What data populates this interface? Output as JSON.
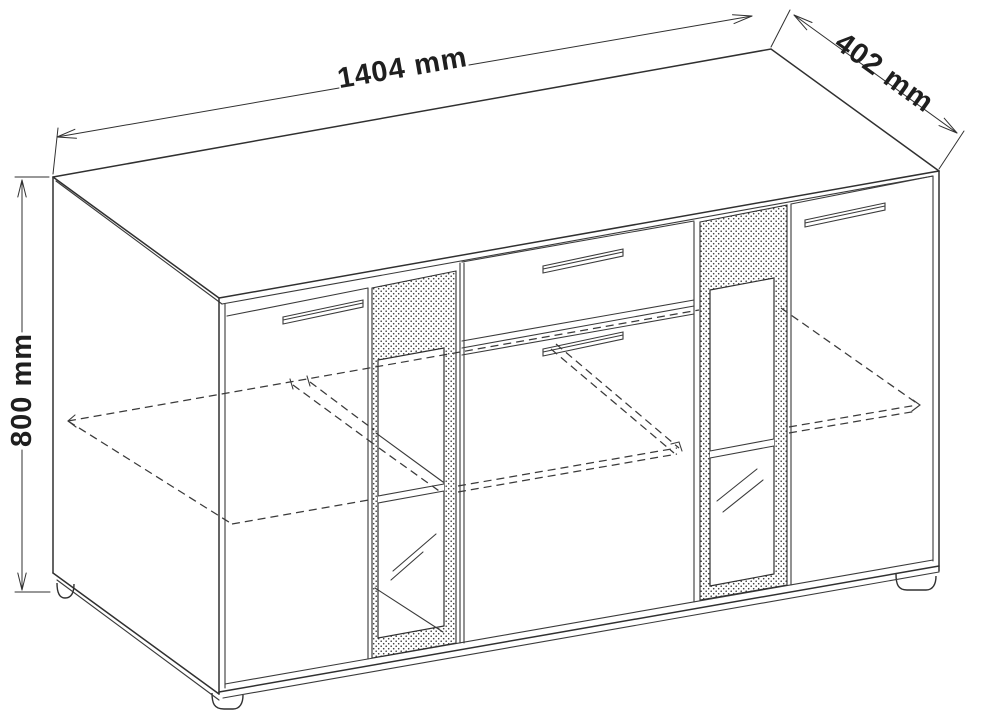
{
  "diagram": {
    "type": "technical-drawing",
    "subject": "sideboard-cabinet-with-glass-doors",
    "background_color": "#ffffff",
    "line_color": "#303030",
    "dimensions": {
      "width": {
        "label": "1404 mm",
        "value": 1404,
        "unit": "mm",
        "edge": "top"
      },
      "depth": {
        "label": "402 mm",
        "value": 402,
        "unit": "mm",
        "edge": "top-right"
      },
      "height": {
        "label": "800 mm",
        "value": 800,
        "unit": "mm",
        "edge": "left"
      }
    }
  }
}
